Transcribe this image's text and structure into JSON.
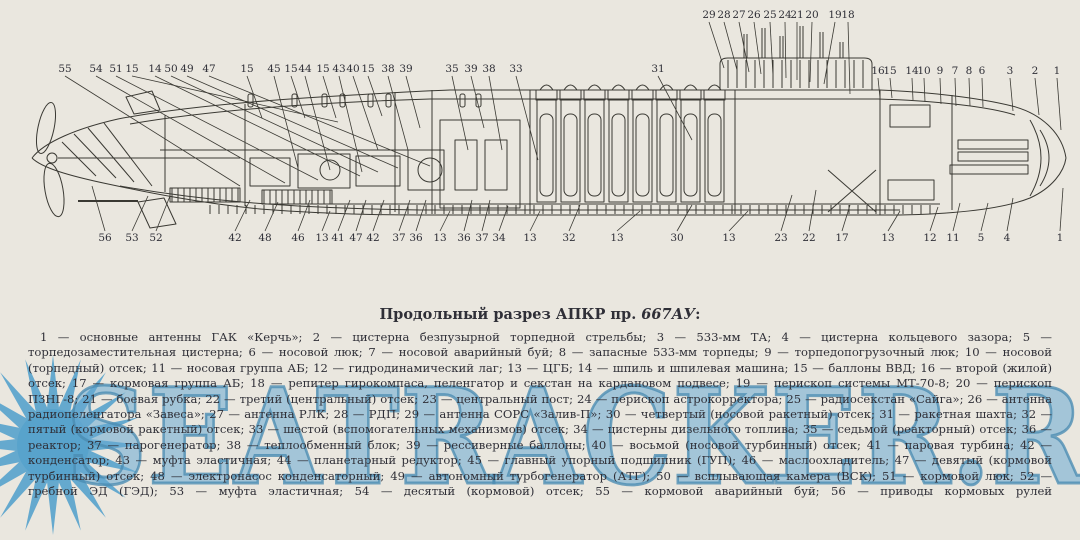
{
  "colors": {
    "background": "#eae7df",
    "ink": "#3a3933",
    "watermark_blue": "#57a2cc",
    "text": "#2f2f37"
  },
  "watermark": {
    "text": "SEATRACKER.RU"
  },
  "title": {
    "prefix": "Продольный разрез АПКР пр. ",
    "project": "667АУ",
    "suffix": ":"
  },
  "legend_items": [
    {
      "num": "1",
      "text": "основные антенны ГАК «Керчь»"
    },
    {
      "num": "2",
      "text": "цистерна безпузырной торпедной стрельбы"
    },
    {
      "num": "3",
      "text": "533-мм ТА"
    },
    {
      "num": "4",
      "text": "цистерна кольцевого зазора"
    },
    {
      "num": "5",
      "text": "торпедозаместительная цистерна"
    },
    {
      "num": "6",
      "text": "носовой люк"
    },
    {
      "num": "7",
      "text": "носовой аварийный буй"
    },
    {
      "num": "8",
      "text": "запасные 533-мм торпеды"
    },
    {
      "num": "9",
      "text": "торпедопогрузочный люк"
    },
    {
      "num": "10",
      "text": "носовой (торпедный) отсек"
    },
    {
      "num": "11",
      "text": "носовая группа АБ"
    },
    {
      "num": "12",
      "text": "гидродинамический лаг"
    },
    {
      "num": "13",
      "text": "ЦГБ"
    },
    {
      "num": "14",
      "text": "шпиль и шпилевая машина"
    },
    {
      "num": "15",
      "text": "баллоны ВВД"
    },
    {
      "num": "16",
      "text": "второй (жилой) отсек"
    },
    {
      "num": "17",
      "text": "кормовая группа АБ"
    },
    {
      "num": "18",
      "text": "репитер гирокомпаса, пеленгатор и секстан на кардановом подвесе"
    },
    {
      "num": "19",
      "text": "перископ системы МТ-70-8"
    },
    {
      "num": "20",
      "text": "перископ ПЗНГ-8"
    },
    {
      "num": "21",
      "text": "боевая рубка"
    },
    {
      "num": "22",
      "text": "третий (центральный) отсек"
    },
    {
      "num": "23",
      "text": "центральный пост"
    },
    {
      "num": "24",
      "text": "перископ астрокорректора"
    },
    {
      "num": "25",
      "text": "радиосекстан «Сайга»"
    },
    {
      "num": "26",
      "text": "антенна радиопеленгатора «Завеса»"
    },
    {
      "num": "27",
      "text": "антенна РЛК"
    },
    {
      "num": "28",
      "text": "РДП"
    },
    {
      "num": "29",
      "text": "антенна СОРС «Залив-П»"
    },
    {
      "num": "30",
      "text": "четвертый (носовой ракетный) отсек"
    },
    {
      "num": "31",
      "text": "ракетная шахта"
    },
    {
      "num": "32",
      "text": "пятый (кормовой ракетный) отсек"
    },
    {
      "num": "33",
      "text": "шестой (вспомогательных механизмов) отсек"
    },
    {
      "num": "34",
      "text": "цистерны дизельного топлива"
    },
    {
      "num": "35",
      "text": "седьмой (реакторный) отсек"
    },
    {
      "num": "36",
      "text": "реактор"
    },
    {
      "num": "37",
      "text": "парогенератор"
    },
    {
      "num": "38",
      "text": "теплообменный блок"
    },
    {
      "num": "39",
      "text": "рессиверные баллоны"
    },
    {
      "num": "40",
      "text": "восьмой (носовой турбинный) отсек"
    },
    {
      "num": "41",
      "text": "паровая турбина"
    },
    {
      "num": "42",
      "text": "конденсатор"
    },
    {
      "num": "43",
      "text": "муфта эластичная"
    },
    {
      "num": "44",
      "text": "планетарный редуктор"
    },
    {
      "num": "45",
      "text": "главный упорный подшипник (ГУП)"
    },
    {
      "num": "46",
      "text": "маслоохладитель"
    },
    {
      "num": "47",
      "text": "девятый (кормовой турбинный) отсек"
    },
    {
      "num": "48",
      "text": "электронасос конденсаторный"
    },
    {
      "num": "49",
      "text": "автономный турбогенератор (АТГ)"
    },
    {
      "num": "50",
      "text": "всплывающая камера (ВСК)"
    },
    {
      "num": "51",
      "text": "кормовой люк"
    },
    {
      "num": "52",
      "text": "гребной ЭД (ГЭД)"
    },
    {
      "num": "53",
      "text": "муфта эластичная"
    },
    {
      "num": "54",
      "text": "десятый (кормовой) отсек"
    },
    {
      "num": "55",
      "text": "кормовой аварийный буй"
    },
    {
      "num": "56",
      "text": "приводы кормовых рулей"
    }
  ],
  "callouts": [
    {
      "n": "55",
      "x": 65,
      "y": 72,
      "tx": 240,
      "ty": 186
    },
    {
      "n": "54",
      "x": 96,
      "y": 72,
      "tx": 285,
      "ty": 183
    },
    {
      "n": "51",
      "x": 116,
      "y": 72,
      "tx": 318,
      "ty": 180
    },
    {
      "n": "15",
      "x": 132,
      "y": 72,
      "tx": 338,
      "ty": 122
    },
    {
      "n": "14",
      "x": 155,
      "y": 72,
      "tx": 360,
      "ty": 176
    },
    {
      "n": "50",
      "x": 171,
      "y": 72,
      "tx": 378,
      "ty": 172
    },
    {
      "n": "49",
      "x": 187,
      "y": 72,
      "tx": 398,
      "ty": 168
    },
    {
      "n": "47",
      "x": 209,
      "y": 72,
      "tx": 430,
      "ty": 166
    },
    {
      "n": "15",
      "x": 247,
      "y": 72,
      "tx": 262,
      "ty": 118
    },
    {
      "n": "45",
      "x": 274,
      "y": 72,
      "tx": 298,
      "ty": 168
    },
    {
      "n": "15",
      "x": 291,
      "y": 72,
      "tx": 305,
      "ty": 118
    },
    {
      "n": "44",
      "x": 305,
      "y": 72,
      "tx": 330,
      "ty": 170
    },
    {
      "n": "15",
      "x": 323,
      "y": 72,
      "tx": 336,
      "ty": 118
    },
    {
      "n": "43",
      "x": 339,
      "y": 72,
      "tx": 362,
      "ty": 172
    },
    {
      "n": "40",
      "x": 353,
      "y": 72,
      "tx": 378,
      "ty": 150
    },
    {
      "n": "15",
      "x": 368,
      "y": 72,
      "tx": 382,
      "ty": 116
    },
    {
      "n": "38",
      "x": 388,
      "y": 72,
      "tx": 408,
      "ty": 150
    },
    {
      "n": "39",
      "x": 406,
      "y": 72,
      "tx": 420,
      "ty": 128
    },
    {
      "n": "35",
      "x": 452,
      "y": 72,
      "tx": 468,
      "ty": 150
    },
    {
      "n": "39",
      "x": 471,
      "y": 72,
      "tx": 484,
      "ty": 128
    },
    {
      "n": "38",
      "x": 489,
      "y": 72,
      "tx": 502,
      "ty": 150
    },
    {
      "n": "33",
      "x": 516,
      "y": 72,
      "tx": 538,
      "ty": 160
    },
    {
      "n": "31",
      "x": 658,
      "y": 72,
      "tx": 692,
      "ty": 140
    },
    {
      "n": "29",
      "x": 709,
      "y": 18,
      "tx": 724,
      "ty": 68
    },
    {
      "n": "28",
      "x": 724,
      "y": 18,
      "tx": 737,
      "ty": 70
    },
    {
      "n": "27",
      "x": 739,
      "y": 18,
      "tx": 749,
      "ty": 72
    },
    {
      "n": "26",
      "x": 754,
      "y": 18,
      "tx": 761,
      "ty": 74
    },
    {
      "n": "25",
      "x": 770,
      "y": 18,
      "tx": 773,
      "ty": 76
    },
    {
      "n": "24",
      "x": 785,
      "y": 18,
      "tx": 786,
      "ty": 78
    },
    {
      "n": "21",
      "x": 797,
      "y": 18,
      "tx": 797,
      "ty": 80
    },
    {
      "n": "20",
      "x": 812,
      "y": 18,
      "tx": 810,
      "ty": 82
    },
    {
      "n": "19",
      "x": 835,
      "y": 18,
      "tx": 824,
      "ty": 84
    },
    {
      "n": "18",
      "x": 848,
      "y": 18,
      "tx": 850,
      "ty": 94
    },
    {
      "n": "16",
      "x": 878,
      "y": 74,
      "tx": 880,
      "ty": 98
    },
    {
      "n": "15",
      "x": 890,
      "y": 74,
      "tx": 892,
      "ty": 98
    },
    {
      "n": "14",
      "x": 912,
      "y": 74,
      "tx": 913,
      "ty": 100
    },
    {
      "n": "10",
      "x": 924,
      "y": 74,
      "tx": 925,
      "ty": 102
    },
    {
      "n": "9",
      "x": 940,
      "y": 74,
      "tx": 941,
      "ty": 104
    },
    {
      "n": "7",
      "x": 955,
      "y": 74,
      "tx": 956,
      "ty": 106
    },
    {
      "n": "8",
      "x": 969,
      "y": 74,
      "tx": 970,
      "ty": 106
    },
    {
      "n": "6",
      "x": 982,
      "y": 74,
      "tx": 983,
      "ty": 107
    },
    {
      "n": "3",
      "x": 1010,
      "y": 74,
      "tx": 1013,
      "ty": 111
    },
    {
      "n": "2",
      "x": 1035,
      "y": 74,
      "tx": 1039,
      "ty": 115
    },
    {
      "n": "1",
      "x": 1057,
      "y": 74,
      "tx": 1061,
      "ty": 130
    },
    {
      "n": "56",
      "x": 105,
      "y": 241,
      "tx": 92,
      "ty": 186
    },
    {
      "n": "53",
      "x": 132,
      "y": 241,
      "tx": 148,
      "ty": 196
    },
    {
      "n": "52",
      "x": 156,
      "y": 241,
      "tx": 170,
      "ty": 196
    },
    {
      "n": "42",
      "x": 235,
      "y": 241,
      "tx": 250,
      "ty": 200
    },
    {
      "n": "48",
      "x": 265,
      "y": 241,
      "tx": 278,
      "ty": 202
    },
    {
      "n": "46",
      "x": 298,
      "y": 241,
      "tx": 310,
      "ty": 200
    },
    {
      "n": "13",
      "x": 322,
      "y": 241,
      "tx": 330,
      "ty": 211
    },
    {
      "n": "41",
      "x": 338,
      "y": 241,
      "tx": 350,
      "ty": 200
    },
    {
      "n": "47",
      "x": 356,
      "y": 241,
      "tx": 366,
      "ty": 200
    },
    {
      "n": "42",
      "x": 373,
      "y": 241,
      "tx": 384,
      "ty": 200
    },
    {
      "n": "37",
      "x": 399,
      "y": 241,
      "tx": 410,
      "ty": 200
    },
    {
      "n": "36",
      "x": 416,
      "y": 241,
      "tx": 426,
      "ty": 200
    },
    {
      "n": "13",
      "x": 440,
      "y": 241,
      "tx": 450,
      "ty": 211
    },
    {
      "n": "36",
      "x": 464,
      "y": 241,
      "tx": 472,
      "ty": 200
    },
    {
      "n": "37",
      "x": 482,
      "y": 241,
      "tx": 490,
      "ty": 200
    },
    {
      "n": "34",
      "x": 499,
      "y": 241,
      "tx": 508,
      "ty": 206
    },
    {
      "n": "13",
      "x": 530,
      "y": 241,
      "tx": 540,
      "ty": 211
    },
    {
      "n": "32",
      "x": 569,
      "y": 241,
      "tx": 580,
      "ty": 205
    },
    {
      "n": "13",
      "x": 617,
      "y": 241,
      "tx": 640,
      "ty": 211
    },
    {
      "n": "30",
      "x": 677,
      "y": 241,
      "tx": 692,
      "ty": 205
    },
    {
      "n": "13",
      "x": 729,
      "y": 241,
      "tx": 748,
      "ty": 211
    },
    {
      "n": "23",
      "x": 781,
      "y": 241,
      "tx": 792,
      "ty": 195
    },
    {
      "n": "22",
      "x": 809,
      "y": 241,
      "tx": 816,
      "ty": 190
    },
    {
      "n": "17",
      "x": 842,
      "y": 241,
      "tx": 850,
      "ty": 205
    },
    {
      "n": "13",
      "x": 888,
      "y": 241,
      "tx": 900,
      "ty": 211
    },
    {
      "n": "12",
      "x": 930,
      "y": 241,
      "tx": 938,
      "ty": 207
    },
    {
      "n": "11",
      "x": 953,
      "y": 241,
      "tx": 960,
      "ty": 203
    },
    {
      "n": "5",
      "x": 981,
      "y": 241,
      "tx": 988,
      "ty": 203
    },
    {
      "n": "4",
      "x": 1007,
      "y": 241,
      "tx": 1013,
      "ty": 198
    },
    {
      "n": "1",
      "x": 1060,
      "y": 241,
      "tx": 1063,
      "ty": 188
    }
  ]
}
